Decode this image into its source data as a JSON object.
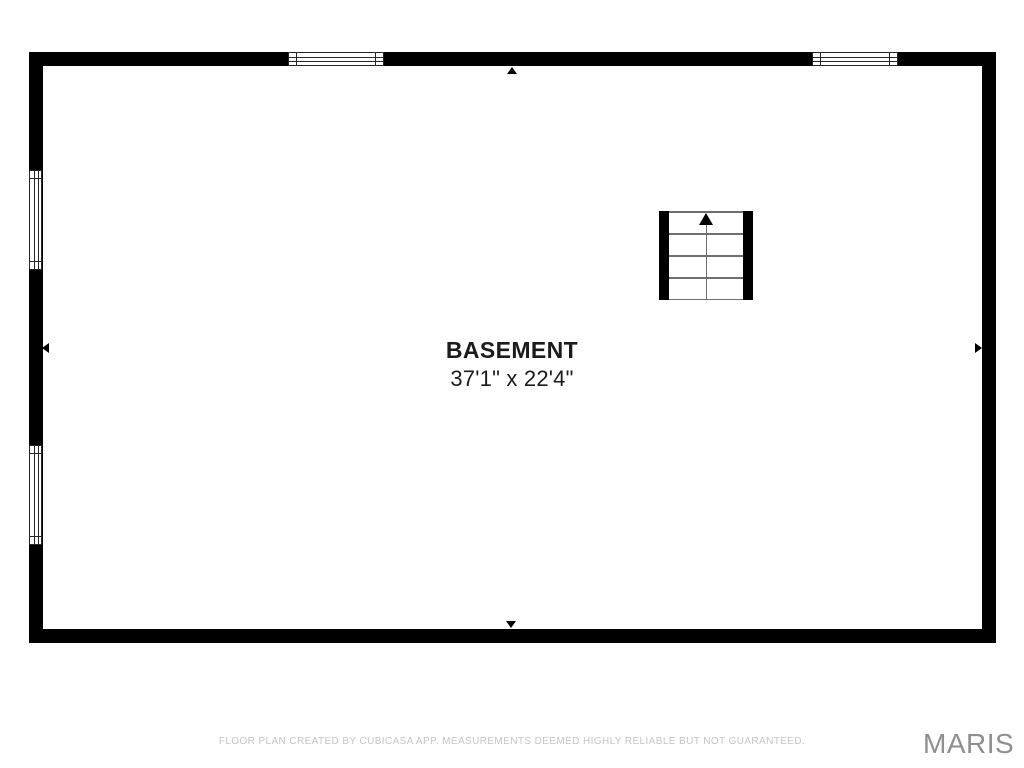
{
  "plan": {
    "room": {
      "name": "BASEMENT",
      "dimensions": "37'1\" x 22'4\""
    },
    "features": {
      "staircase": "stairs-up",
      "windows_top_wall": 2,
      "windows_left_wall": 2
    },
    "colors": {
      "wall": "#000000",
      "background": "#ffffff",
      "stair_lines": "#6e6e6e",
      "label_text": "#1b1b1b",
      "disclaimer_text": "#c5c5c5",
      "logo_text": "#8f8f8f"
    }
  },
  "footer": {
    "disclaimer": "FLOOR PLAN CREATED BY CUBICASA APP. MEASUREMENTS DEEMED HIGHLY RELIABLE BUT NOT GUARANTEED.",
    "brand": "MARIS"
  }
}
